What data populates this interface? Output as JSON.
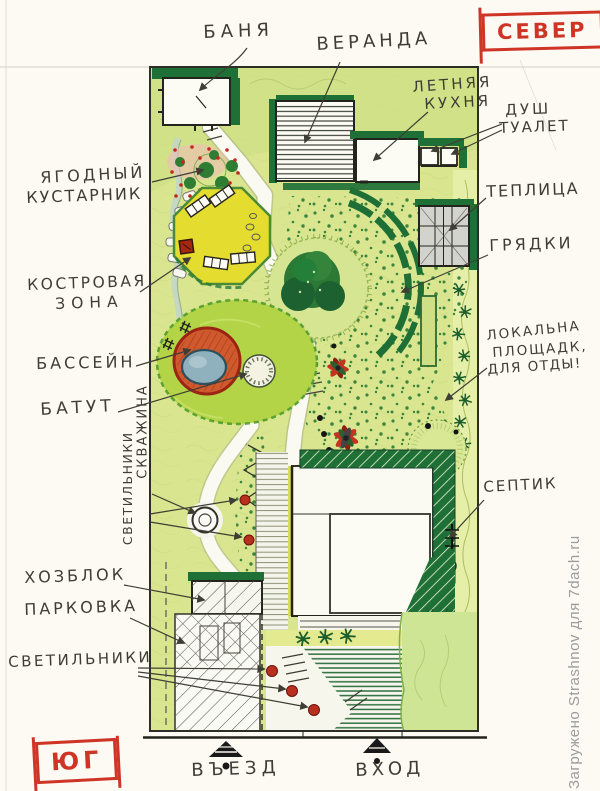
{
  "compass": {
    "north": "СЕВЕР",
    "south": "ЮГ"
  },
  "watermark": "Загружено Strashnov для 7dach.ru",
  "labels": {
    "banya": "БАНЯ",
    "veranda": "ВЕРАНДА",
    "kitchen1": "ЛЕТНЯЯ",
    "kitchen2": "КУХНЯ",
    "shower": "ДУШ",
    "toilet": "ТУАЛЕТ",
    "greenhouse": "ТЕПЛИЦА",
    "beds": "ГРЯДКИ",
    "berry1": "ЯГОДНЫЙ",
    "berry2": "КУСТАРНИК",
    "fire1": "КОСТРОВАЯ",
    "fire2": "ЗОНА",
    "pool": "БАССЕЙН",
    "trampoline": "БАТУТ",
    "well_v": "СКВАЖИНА",
    "lights_v": "СВЕТИЛЬНИКИ",
    "local1": "ЛОКАЛЬНА",
    "local2": "ПЛОЩАДК,",
    "local3": "ДЛЯ ОТДЫ!",
    "septic": "СЕПТИК",
    "utility": "ХОЗБЛОК",
    "parking": "ПАРКОВКА",
    "lights": "СВЕТИЛЬНИКИ",
    "driveway": "ВЪЕЗД",
    "entrance": "ВХОД"
  },
  "colors": {
    "accent_red": "#cf3526",
    "ink": "#3f3e35",
    "plot_green": "#d9e68f",
    "dark_green": "#1f7036",
    "lawn_green": "#b2d446",
    "fire_zone_yellow": "#e4dc2e",
    "pool_orange": "#cf5a2d",
    "water_blue": "#8fb0bd",
    "lamp_red": "#b8301f",
    "watermark_gray": "#9c9c9c"
  }
}
